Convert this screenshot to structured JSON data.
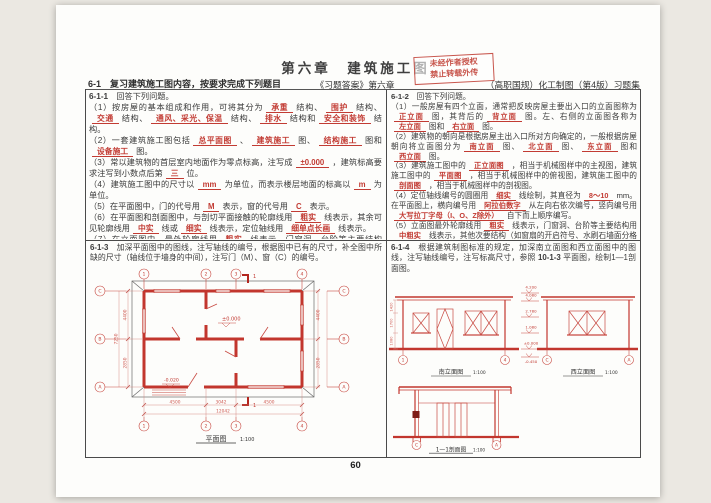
{
  "page": {
    "title": "第六章　建筑施工图",
    "stamp": {
      "line1": "未经作者授权",
      "line2": "禁止转载外传"
    },
    "header": {
      "left": "6-1　复习建筑施工图内容，按要求完成下列题目",
      "center": "《习题答案》第六章",
      "right": "（高职国规）化工制图（第4版）习题集"
    },
    "page_number": "60"
  },
  "q611": {
    "intro": [
      {
        "b": "6-1-1"
      },
      {
        "t": "　回答下列问题。"
      }
    ],
    "paras": [
      [
        {
          "t": "（1）按房屋的基本组成和作用，可将其分为"
        },
        {
          "a": "承重"
        },
        {
          "t": "结构、"
        },
        {
          "a": "围护"
        },
        {
          "t": "结构、"
        },
        {
          "a": "交通"
        },
        {
          "t": "结构、"
        },
        {
          "a": "通风、采光、保温"
        },
        {
          "t": "结构、"
        },
        {
          "a": "排水"
        },
        {
          "t": "结构和"
        },
        {
          "a": "安全和装饰"
        },
        {
          "t": "结构。"
        }
      ],
      [
        {
          "t": "（2）一套建筑施工图包括"
        },
        {
          "a": "总平面图"
        },
        {
          "t": "、"
        },
        {
          "a": "建筑施工"
        },
        {
          "t": "图、"
        },
        {
          "a": "结构施工"
        },
        {
          "t": "图和"
        },
        {
          "a": "设备施工"
        },
        {
          "t": "图。"
        }
      ],
      [
        {
          "t": "（3）常以建筑物的首层室内地面作为零点标高，注写成"
        },
        {
          "a": "±0.000"
        },
        {
          "t": "，建筑标高要求注写到小数点后第"
        },
        {
          "a": "三"
        },
        {
          "t": "位。"
        }
      ],
      [
        {
          "t": "（4）建筑施工图中的尺寸以"
        },
        {
          "a": "mm"
        },
        {
          "t": "为单位，而表示楼层地面的标高以"
        },
        {
          "a": "m"
        },
        {
          "t": "为单位。"
        }
      ],
      [
        {
          "t": "（5）在平面图中，门的代号用"
        },
        {
          "a": "M"
        },
        {
          "t": "表示，窗的代号用"
        },
        {
          "a": "C"
        },
        {
          "t": "表示。"
        }
      ],
      [
        {
          "t": "（6）在平面图和剖面图中，与剖切平面接触的轮廓线用"
        },
        {
          "a": "粗实"
        },
        {
          "t": "线表示，其余可见轮廓线用"
        },
        {
          "a": "中实"
        },
        {
          "t": "线或"
        },
        {
          "a": "细实"
        },
        {
          "t": "线表示，定位轴线用"
        },
        {
          "a": "细单点长画"
        },
        {
          "t": "线表示。"
        }
      ],
      [
        {
          "t": "（7）在立面图中，最外轮廓线用"
        },
        {
          "a": "粗实"
        },
        {
          "t": "线表示，门窗洞、台阶等主要结构"
        },
        {
          "a": "中粗实"
        },
        {
          "t": "线表示，其他次要结构用"
        },
        {
          "a": "细实"
        },
        {
          "t": "线表示，地坪线用"
        },
        {
          "a": "特粗实"
        },
        {
          "t": "线表示。"
        }
      ]
    ]
  },
  "q612": {
    "intro": [
      {
        "b": "6-1-2"
      },
      {
        "t": "　回答下列问题。"
      }
    ],
    "paras": [
      [
        {
          "t": "（1）一般房屋有四个立面，通常把反映房屋主要出入口的立面图称为"
        },
        {
          "a": "正立面"
        },
        {
          "t": "图，其背后的"
        },
        {
          "a": "背立面"
        },
        {
          "t": "图。左、右侧的立面图各称为"
        },
        {
          "a": "左立面"
        },
        {
          "t": "图和"
        },
        {
          "a": "右立面"
        },
        {
          "t": "图。"
        }
      ],
      [
        {
          "t": "（2）建筑物的朝向是根据房屋主出入口所对方向确定的，一般根据房屋朝向将立面图分为"
        },
        {
          "a": "南立面"
        },
        {
          "t": "图、"
        },
        {
          "a": "北立面"
        },
        {
          "t": "图、"
        },
        {
          "a": "东立面"
        },
        {
          "t": "图和"
        },
        {
          "a": "西立面"
        },
        {
          "t": "图。"
        }
      ],
      [
        {
          "t": "（3）建筑施工图中的"
        },
        {
          "a": "正立面图"
        },
        {
          "t": "，相当于机械图样中的主视图，建筑施工图中的"
        },
        {
          "a": "平面图"
        },
        {
          "t": "，相当于机械图样中的俯视图，建筑施工图中的"
        },
        {
          "a": "剖面图"
        },
        {
          "t": "，相当于机械图样中的剖视图。"
        }
      ],
      [
        {
          "t": "（4）定位轴线编号的圆圈用"
        },
        {
          "a": "细实"
        },
        {
          "t": "线绘制，其直径为"
        },
        {
          "a": "8～10"
        },
        {
          "t": "mm。在平面图上，横向编号用"
        },
        {
          "a": "阿拉伯数字"
        },
        {
          "t": "从左向右依次编号，竖向编号用"
        },
        {
          "a": "大写拉丁字母（I、O、Z除外）"
        },
        {
          "t": "自下而上顺序编写。"
        }
      ],
      [
        {
          "t": "（5）立面图最外轮廓线用"
        },
        {
          "a": "粗实"
        },
        {
          "t": "线表示，门窗洞、台阶等主要结构用"
        },
        {
          "a": "中粗实"
        },
        {
          "t": "线表示，其他次要结构（如窗扇的开启符号、水刷石墙面分格线、雨水管等）用"
        },
        {
          "a": "细实"
        },
        {
          "t": "线表示。"
        }
      ]
    ]
  },
  "drawings": {
    "plan": {
      "task": [
        {
          "b": "6-1-3"
        },
        {
          "t": "　加深平面图中的图线，注写轴线的编号，根据图中已有的尺寸，补全图中所缺的尺寸（轴线位于墙身的中间），注写门（M）、窗（C）的编号。"
        }
      ],
      "title": "平面图",
      "scale": "1:100",
      "axes_h": [
        "1",
        "2",
        "3",
        "4"
      ],
      "axes_v": [
        "C",
        "B",
        "A"
      ],
      "dims_bottom": [
        "4500",
        "3042",
        "4500"
      ],
      "dim_bottom_total": "12042",
      "dims_side": [
        "4400",
        "2850"
      ],
      "dim_side_total": "7250",
      "elev_zero": "±0.000",
      "elev_porch": "-0.020",
      "section_label": "1"
    },
    "elevations": {
      "task": [
        {
          "b": "6-1-4"
        },
        {
          "t": "　根据建筑制图标准的规定，加深南立面图和西立面图中的图线，注写轴线编号，注写标高尺寸，参照 "
        },
        {
          "b": "10-1-3"
        },
        {
          "t": " 平面图，绘制1—1剖面图。"
        }
      ],
      "south": {
        "title": "南立面图",
        "scale": "1:100",
        "axis_left": "1",
        "axis_right": "4"
      },
      "west": {
        "title": "西立面图",
        "scale": "1:100",
        "axis_left": "C",
        "axis_right": "A"
      },
      "marks": [
        "4.200",
        "4.080",
        "2.780",
        "1.080",
        "±0.000",
        "-0.450"
      ],
      "height_dims": [
        "1420",
        "1700",
        "1080"
      ],
      "section": {
        "title": "1—1剖面图",
        "scale": "1:100",
        "axis_left": "C",
        "axis_right": "A"
      }
    }
  }
}
